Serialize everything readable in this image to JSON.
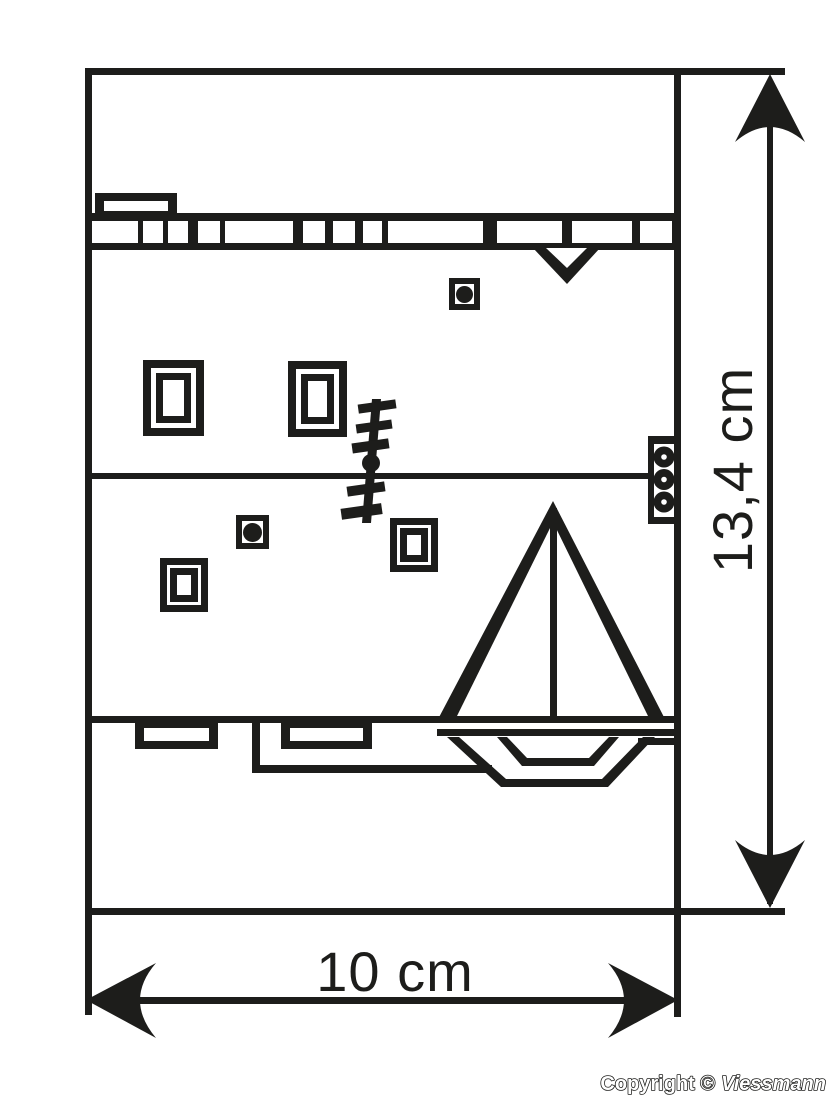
{
  "diagram": {
    "type": "technical-dimension-drawing",
    "dimensions": {
      "height_label": "13,4 cm",
      "width_label": "10 cm"
    },
    "footer": {
      "copyright_prefix": "Copyright ©",
      "brand": "Viessmann"
    },
    "icons": {
      "sailboat": "sailboat-silhouette",
      "windows": "nested-rectangle-windows",
      "portholes": "square-with-dot",
      "hinge": "three-circle-strip",
      "tree": "jagged-pole-tree"
    },
    "colors": {
      "ink": "#1d1d1b",
      "paper": "#ffffff"
    }
  }
}
